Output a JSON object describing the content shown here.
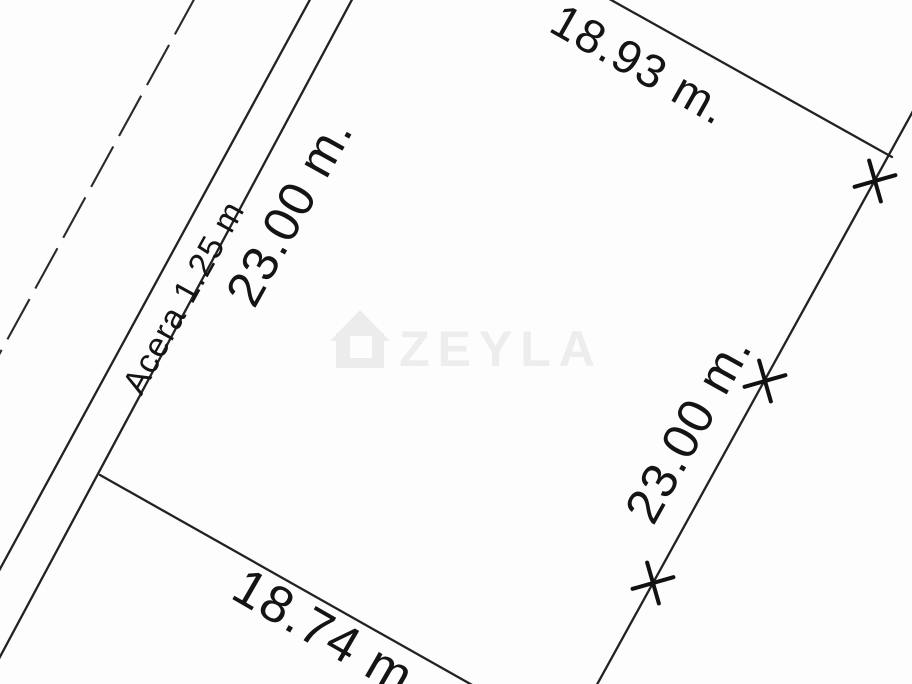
{
  "drawing": {
    "background_color": "#fdfdfd",
    "line_color": "#222222",
    "text_color": "#141414",
    "dimensions": {
      "top": "18.93 m.",
      "left": "23.00 m.",
      "right": "23.00 m.",
      "bottom": "18.74 m",
      "sidewalk": "Acera 1.25 m"
    },
    "watermark": {
      "text": "ZEYLA",
      "icon": "house-icon",
      "color": "#ececec"
    }
  }
}
